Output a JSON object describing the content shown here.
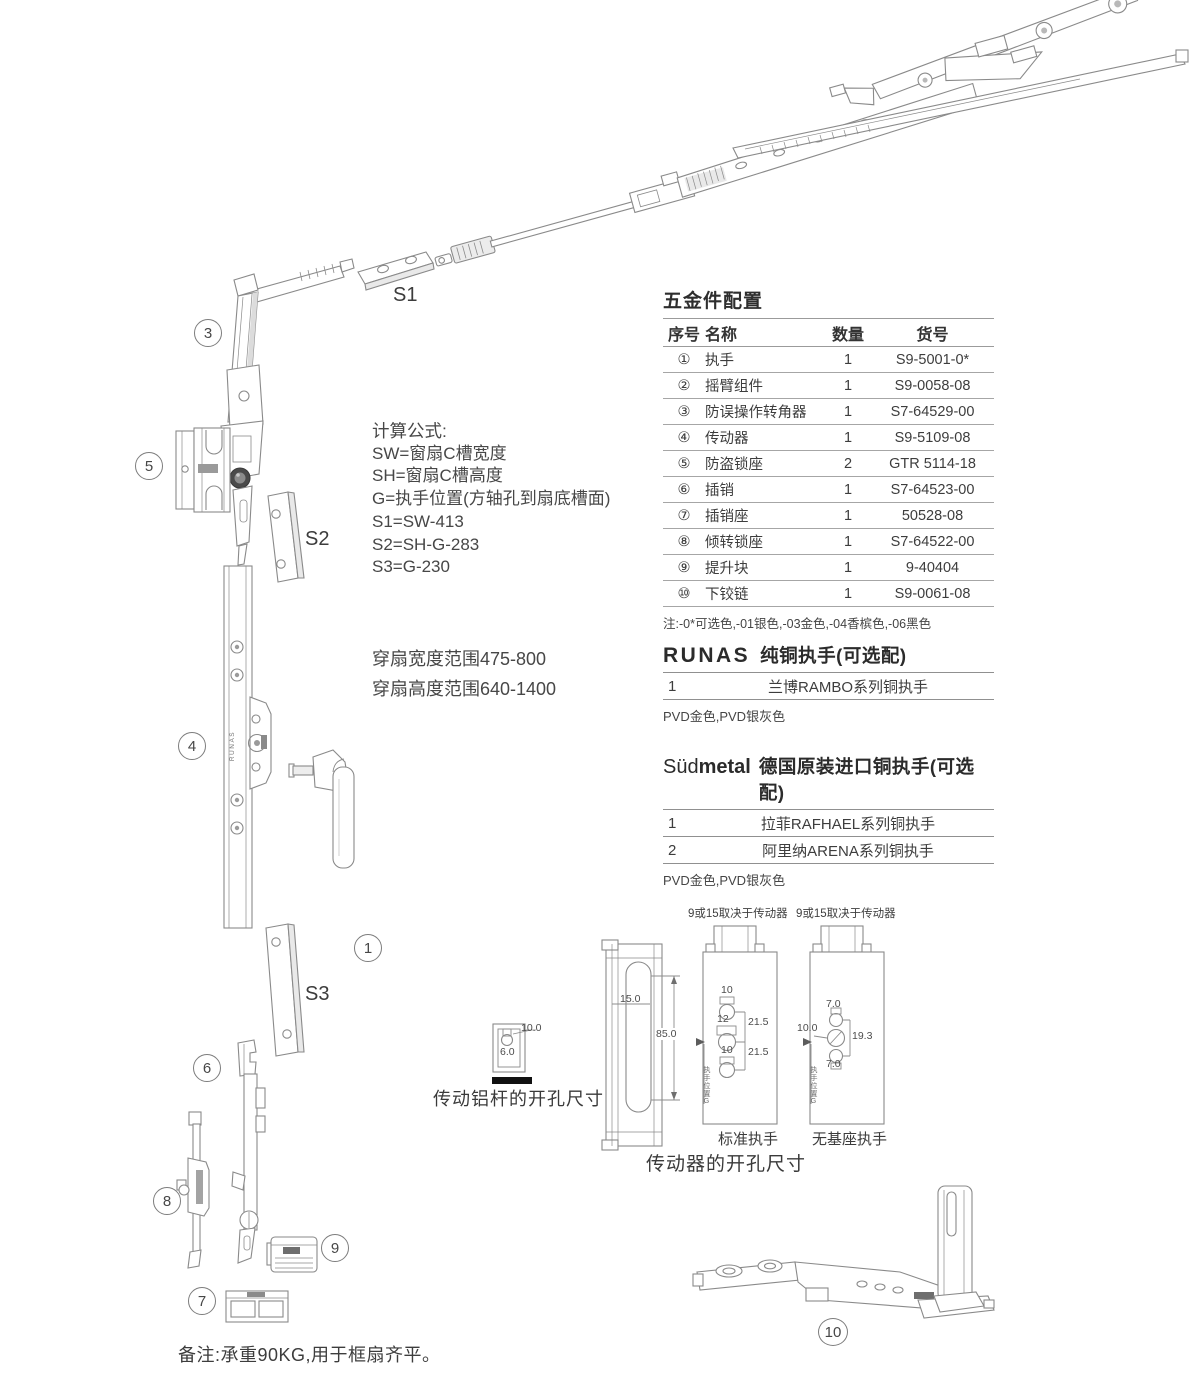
{
  "colors": {
    "line": "#8a8a8a",
    "text": "#3f3f3f",
    "accent_dark": "#3f3f3f"
  },
  "callouts": {
    "n1": "1",
    "n3": "3",
    "n4": "4",
    "n5": "5",
    "n6": "6",
    "n7": "7",
    "n8": "8",
    "n9": "9",
    "n10": "10"
  },
  "plates": {
    "s1": "S1",
    "s2": "S2",
    "s3": "S3"
  },
  "drawing_labels": {
    "runas_vertical": "RUNAS"
  },
  "formulas": {
    "title": "计算公式:",
    "lines": [
      "SW=窗扇C槽宽度",
      "SH=窗扇C槽高度",
      "G=执手位置(方轴孔到扇底槽面)",
      "S1=SW-413",
      "S2=SH-G-283",
      "S3=G-230"
    ]
  },
  "sash_range": {
    "line1": "穿扇宽度范围475-800",
    "line2": "穿扇高度范围640-1400"
  },
  "parts_table": {
    "title": "五金件配置",
    "headers": {
      "no": "序号",
      "name": "名称",
      "qty": "数量",
      "code": "货号"
    },
    "rows": [
      {
        "no": "①",
        "name": "执手",
        "qty": "1",
        "code": "S9-5001-0*"
      },
      {
        "no": "②",
        "name": "摇臂组件",
        "qty": "1",
        "code": "S9-0058-08"
      },
      {
        "no": "③",
        "name": "防误操作转角器",
        "qty": "1",
        "code": "S7-64529-00"
      },
      {
        "no": "④",
        "name": "传动器",
        "qty": "1",
        "code": "S9-5109-08"
      },
      {
        "no": "⑤",
        "name": "防盗锁座",
        "qty": "2",
        "code": "GTR 5114-18"
      },
      {
        "no": "⑥",
        "name": "插销",
        "qty": "1",
        "code": "S7-64523-00"
      },
      {
        "no": "⑦",
        "name": "插销座",
        "qty": "1",
        "code": "50528-08"
      },
      {
        "no": "⑧",
        "name": "倾转锁座",
        "qty": "1",
        "code": "S7-64522-00"
      },
      {
        "no": "⑨",
        "name": "提升块",
        "qty": "1",
        "code": "9-40404"
      },
      {
        "no": "⑩",
        "name": "下铰链",
        "qty": "1",
        "code": "S9-0061-08"
      }
    ],
    "note": "注:-0*可选色,-01银色,-03金色,-04香槟色,-06黑色"
  },
  "runas": {
    "brand": "RUNAS",
    "title": "纯铜执手(可选配)",
    "rows": [
      {
        "no": "1",
        "name": "兰博RAMBO系列铜执手"
      }
    ],
    "footer": "PVD金色,PVD银灰色"
  },
  "sudmetal": {
    "brand_light": "Süd",
    "brand_bold": "metal",
    "title": "德国原装进口铜执手(可选配)",
    "rows": [
      {
        "no": "1",
        "name": "拉菲RAFHAEL系列铜执手"
      },
      {
        "no": "2",
        "name": "阿里纳ARENA系列铜执手"
      }
    ],
    "footer": "PVD金色,PVD银灰色"
  },
  "drill_rod": {
    "caption": "传动铝杆的开孔尺寸",
    "dim_top": "10.0",
    "dim_bottom": "6.0"
  },
  "drill_drive": {
    "caption": "传动器的开孔尺寸",
    "profile": {
      "slot_width": "15.0",
      "slot_height": "85.0"
    },
    "standard": {
      "top_label": "9或15取决于传动器",
      "hole1": "10",
      "hole2": "12",
      "hole3": "10",
      "span1": "21.5",
      "span2": "21.5",
      "side_label": "执手位置G",
      "caption": "标准执手"
    },
    "nobase": {
      "top_label": "9或15取决于传动器",
      "top": "7.0",
      "left": "10.0",
      "right": "19.3",
      "bottom": "7.0",
      "side_label": "执手位置G",
      "caption": "无基座执手"
    }
  },
  "footnote": "备注:承重90KG,用于框扇齐平。"
}
